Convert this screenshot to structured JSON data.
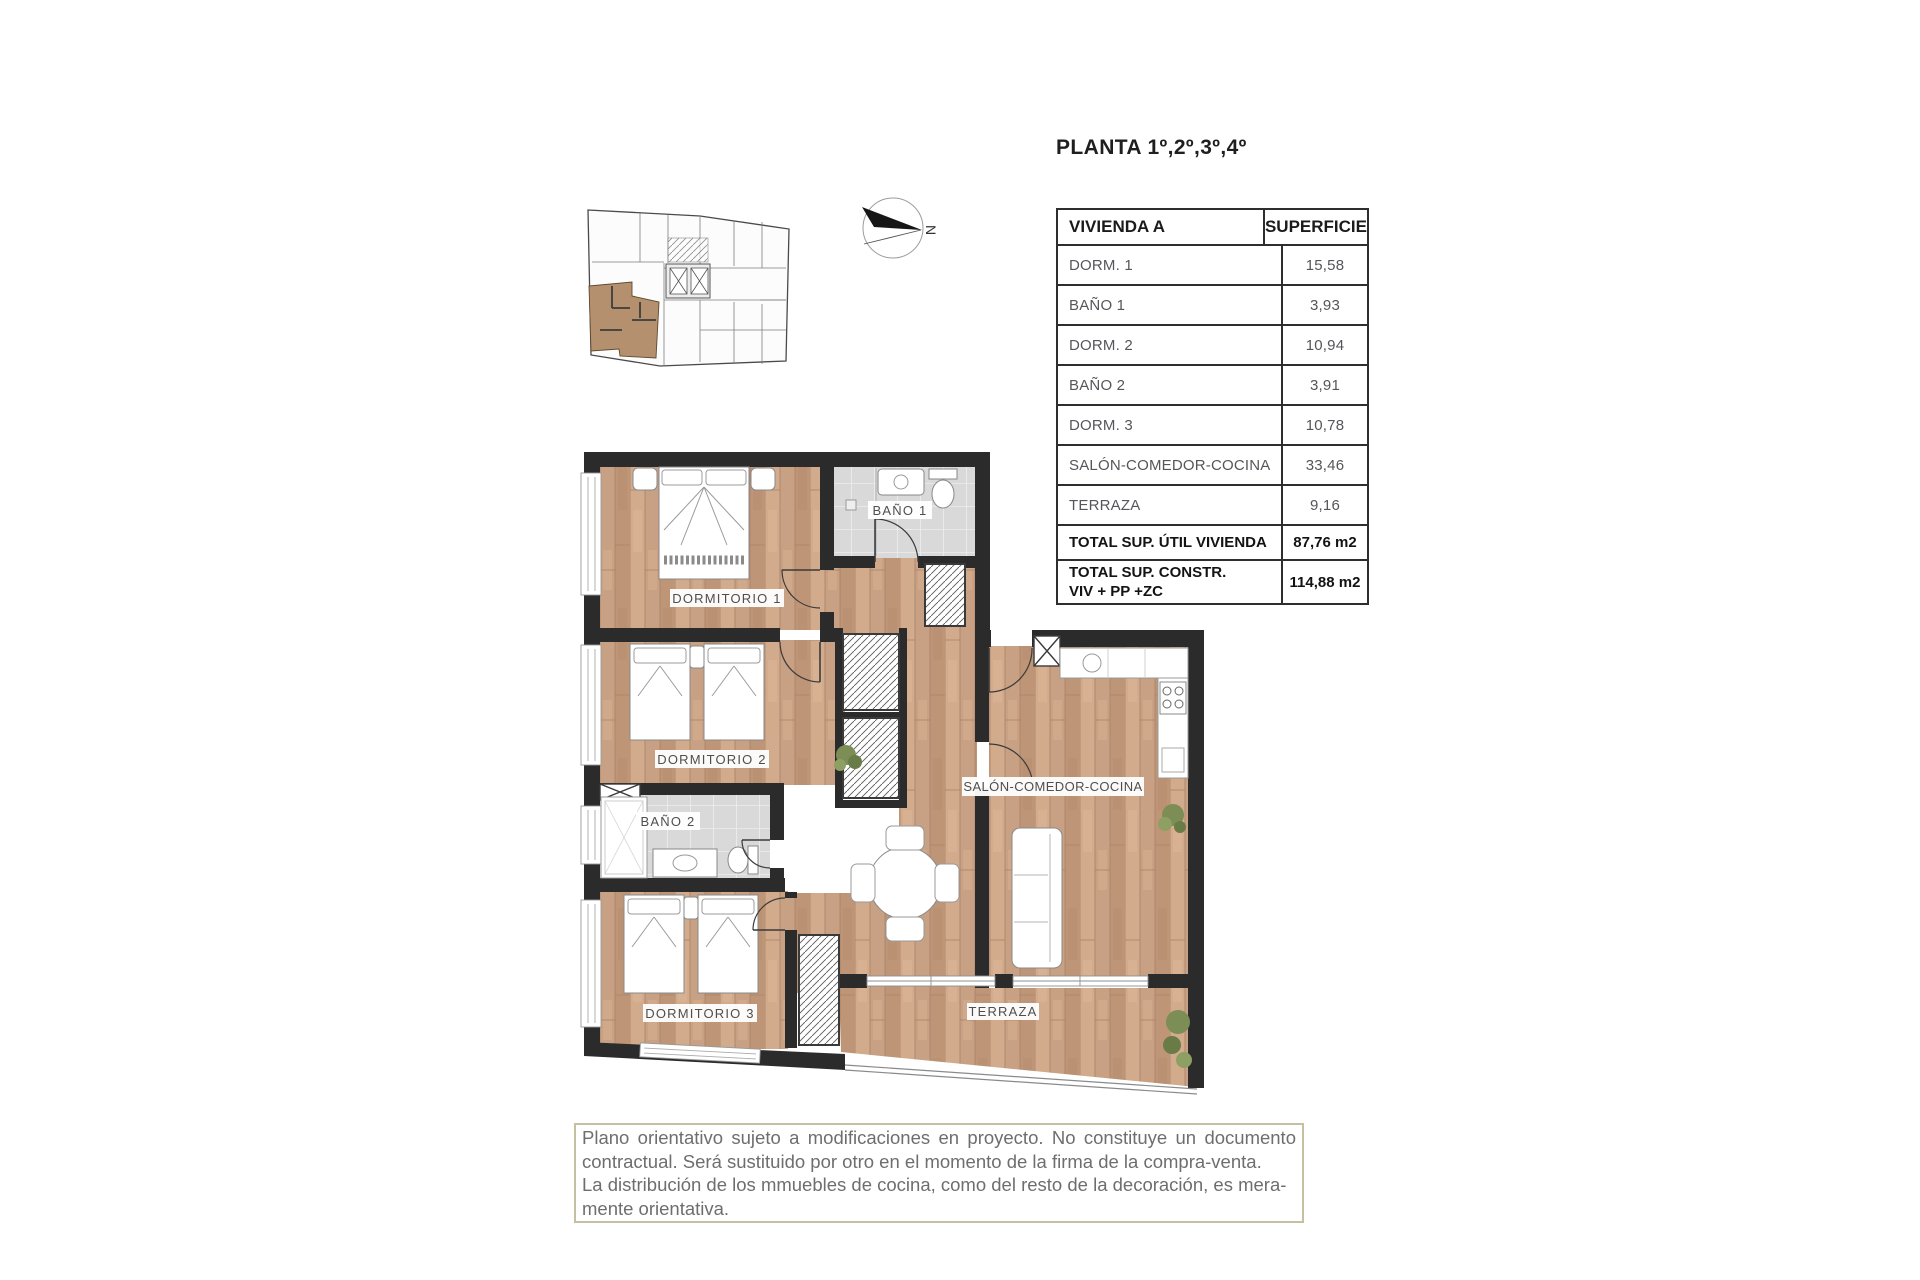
{
  "title": "PLANTA 1º,2º,3º,4º",
  "table": {
    "headers": [
      "VIVIENDA A",
      "SUPERFICIE"
    ],
    "rows": [
      {
        "label": "DORM. 1",
        "value": "15,58"
      },
      {
        "label": "BAÑO 1",
        "value": "3,93"
      },
      {
        "label": "DORM. 2",
        "value": "10,94"
      },
      {
        "label": "BAÑO 2",
        "value": "3,91"
      },
      {
        "label": "DORM. 3",
        "value": "10,78"
      },
      {
        "label": "SALÓN-COMEDOR-COCINA",
        "value": "33,46"
      },
      {
        "label": "TERRAZA",
        "value": "9,16"
      }
    ],
    "totals": [
      {
        "label": "TOTAL SUP. ÚTIL VIVIENDA",
        "value": "87,76 m2"
      },
      {
        "label_lines": [
          "TOTAL SUP. CONSTR.",
          "VIV + PP +ZC"
        ],
        "value": "114,88 m2"
      }
    ]
  },
  "plan": {
    "rooms": [
      {
        "label": "DORMITORIO 1"
      },
      {
        "label": "BAÑO 1"
      },
      {
        "label": "DORMITORIO 2"
      },
      {
        "label": "BAÑO 2"
      },
      {
        "label": "DORMITORIO 3"
      },
      {
        "label": "SALÓN-COMEDOR-COCINA"
      },
      {
        "label": "TERRAZA"
      }
    ]
  },
  "compass": {
    "north_label": "N"
  },
  "disclaimer": {
    "lines": [
      "Plano orientativo sujeto a modificaciones en proyecto. No constituye un documento",
      "contractual. Será sustituido por otro en el momento de la firma de la compra-venta.",
      "La distribución de los mmuebles de cocina, como del resto de la decoración, es mera-",
      "mente orientativa."
    ]
  },
  "colors": {
    "wall": "#2b2b2b",
    "wood": "#c8a083",
    "tile": "#d9d9d9",
    "highlighted_unit": "#b5906e",
    "disclaimer_border": "#c5c1a0",
    "table_text": "#55565a"
  }
}
